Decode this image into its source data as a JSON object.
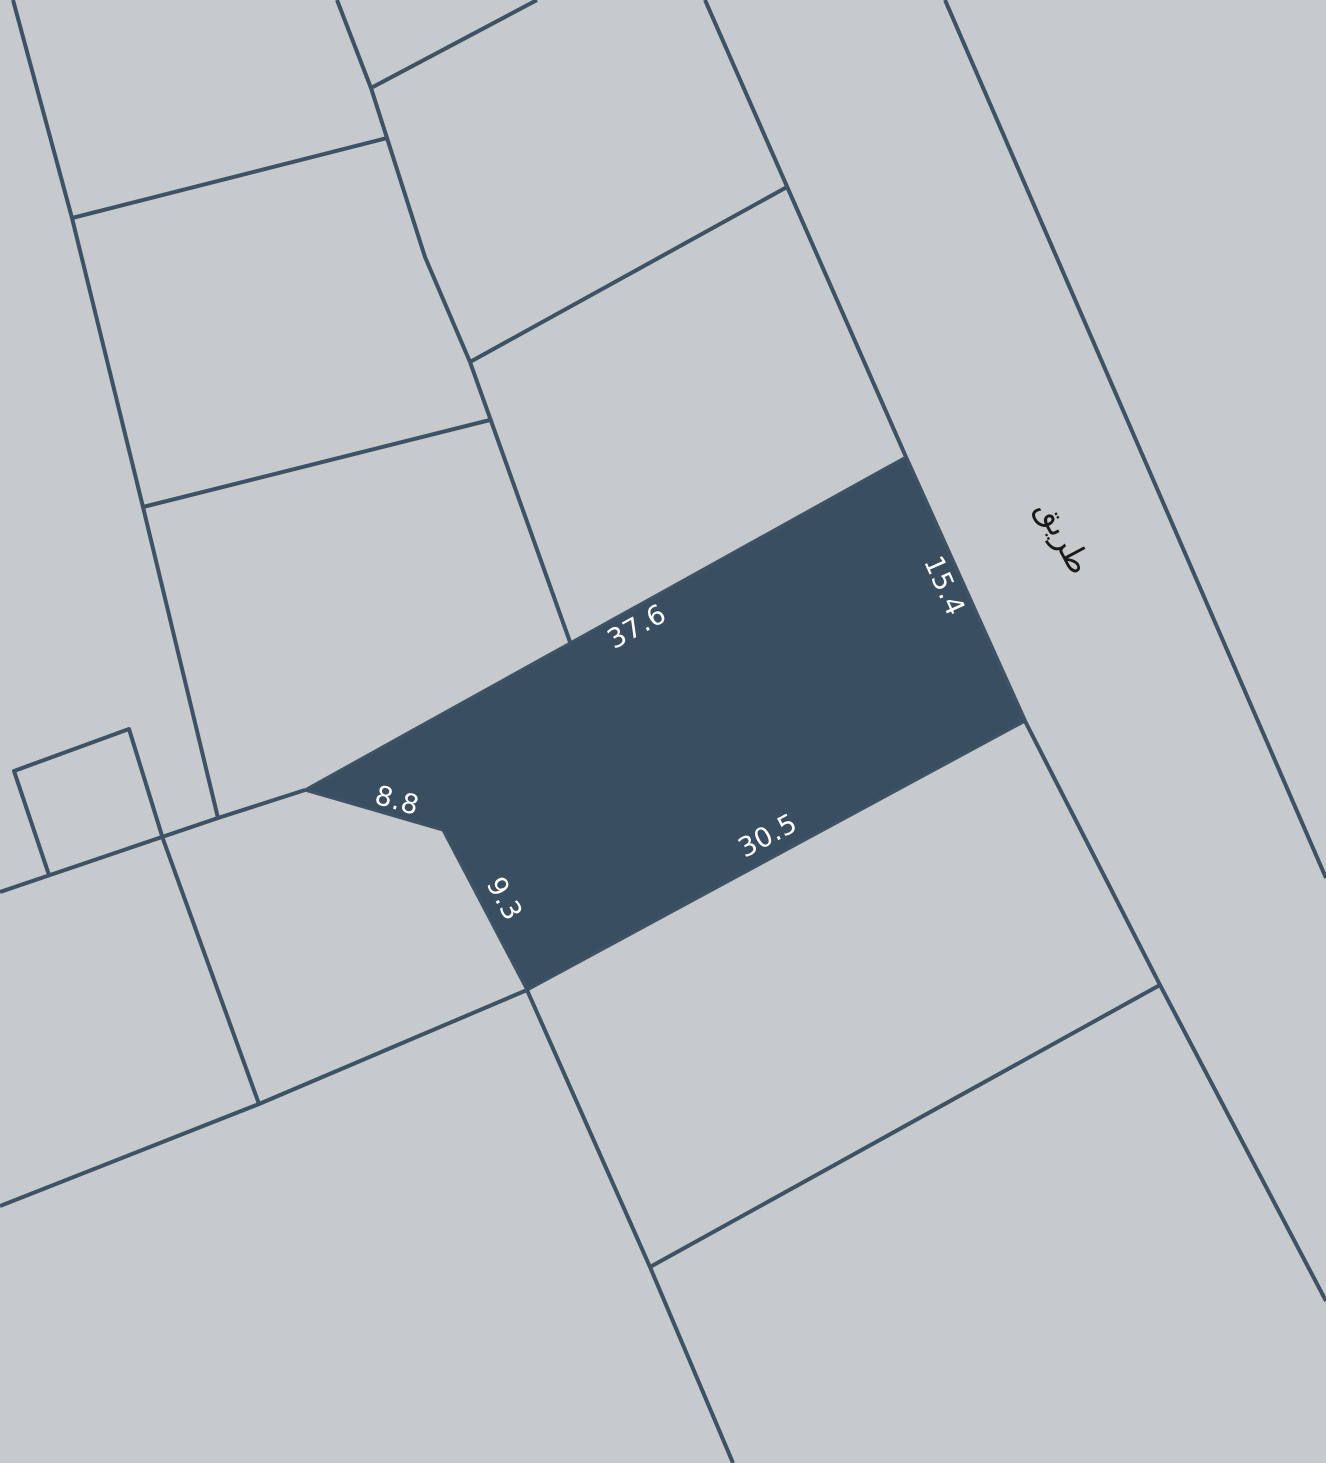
{
  "canvas": {
    "width": 1326,
    "height": 1463
  },
  "colors": {
    "background": "#c6cacd",
    "boundary_line": "#3e5266",
    "selected_parcel_fill": "#3a4e62",
    "dimension_text": "#ffffff",
    "road_text": "#1a1a1a"
  },
  "stroke_width": 4,
  "road": {
    "label": "طريق",
    "x": 1064,
    "y": 537,
    "rotation": 62,
    "font_size": 32
  },
  "selected_parcel": {
    "points": [
      [
        305,
        790
      ],
      [
        443,
        830
      ],
      [
        527,
        990
      ],
      [
        1025,
        721
      ],
      [
        906,
        457
      ]
    ],
    "font_size": 27,
    "dimension_labels": [
      {
        "edge": "north",
        "text": "37.6",
        "x": 637,
        "y": 627,
        "rotation": -29
      },
      {
        "edge": "road-side",
        "text": "15.4",
        "x": 944,
        "y": 586,
        "rotation": 66
      },
      {
        "edge": "notch",
        "text": "8.8",
        "x": 397,
        "y": 801,
        "rotation": 16
      },
      {
        "edge": "lower-west",
        "text": "9.3",
        "x": 504,
        "y": 899,
        "rotation": 62
      },
      {
        "edge": "south",
        "text": "30.5",
        "x": 768,
        "y": 836,
        "rotation": -28
      }
    ]
  },
  "boundaries": [
    {
      "name": "west-lot-line",
      "points": [
        [
          13,
          0
        ],
        [
          72,
          218
        ],
        [
          143,
          507
        ],
        [
          218,
          818
        ]
      ]
    },
    {
      "name": "upper-cross-line",
      "points": [
        [
          72,
          218
        ],
        [
          387,
          138
        ]
      ]
    },
    {
      "name": "top-stub-line",
      "points": [
        [
          337,
          0
        ],
        [
          371,
          88
        ]
      ]
    },
    {
      "name": "top-diagonal-line",
      "points": [
        [
          371,
          88
        ],
        [
          537,
          0
        ]
      ]
    },
    {
      "name": "inner-lot-line",
      "points": [
        [
          371,
          88
        ],
        [
          387,
          138
        ],
        [
          425,
          257
        ],
        [
          470,
          362
        ]
      ]
    },
    {
      "name": "mid-lot-line",
      "points": [
        [
          470,
          362
        ],
        [
          570,
          642
        ]
      ]
    },
    {
      "name": "northeast-diagonal",
      "points": [
        [
          470,
          362
        ],
        [
          787,
          187
        ]
      ]
    },
    {
      "name": "west-cross-line",
      "points": [
        [
          143,
          507
        ],
        [
          490,
          420
        ]
      ]
    },
    {
      "name": "southwest-diagonal",
      "points": [
        [
          0,
          892
        ],
        [
          218,
          818
        ],
        [
          305,
          790
        ]
      ]
    },
    {
      "name": "small-lot-outline",
      "points": [
        [
          49,
          875
        ],
        [
          14,
          771
        ],
        [
          129,
          729
        ],
        [
          163,
          839
        ]
      ]
    },
    {
      "name": "small-lot-extension",
      "points": [
        [
          163,
          839
        ],
        [
          259,
          1104
        ]
      ]
    },
    {
      "name": "lower-west-diagonal",
      "points": [
        [
          0,
          1206
        ],
        [
          259,
          1104
        ],
        [
          527,
          990
        ]
      ]
    },
    {
      "name": "road-west-edge",
      "points": [
        [
          705,
          0
        ],
        [
          906,
          457
        ],
        [
          1025,
          721
        ],
        [
          1160,
          985
        ],
        [
          1326,
          1301
        ]
      ]
    },
    {
      "name": "road-east-edge",
      "points": [
        [
          945,
          0
        ],
        [
          1326,
          878
        ]
      ]
    },
    {
      "name": "south-lot-line",
      "points": [
        [
          527,
          990
        ],
        [
          650,
          1267
        ],
        [
          733,
          1463
        ]
      ]
    },
    {
      "name": "southeast-cross-line",
      "points": [
        [
          650,
          1267
        ],
        [
          1160,
          985
        ]
      ]
    }
  ]
}
